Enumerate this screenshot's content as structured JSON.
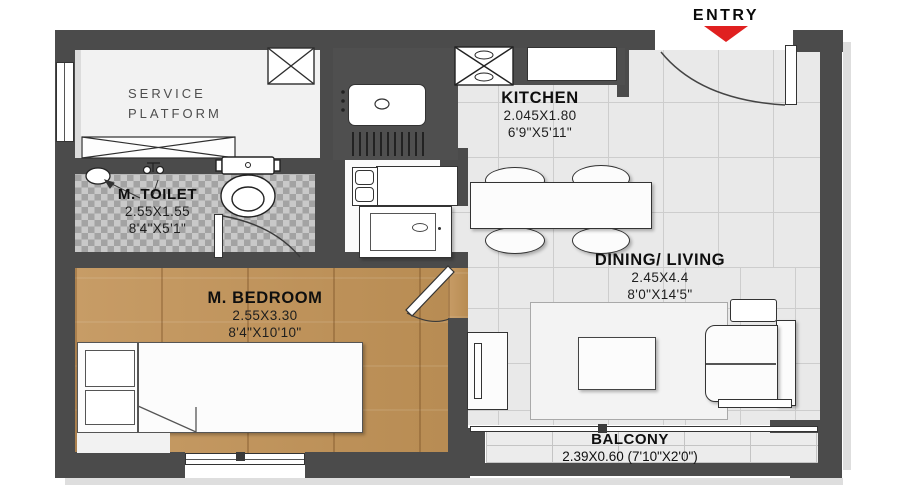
{
  "entry": {
    "label": "ENTRY"
  },
  "rooms": {
    "service_platform": {
      "line1": "SERVICE",
      "line2": "PLATFORM"
    },
    "kitchen": {
      "name": "KITCHEN",
      "dim_m": "2.045X1.80",
      "dim_ft": "6'9\"X5'11\""
    },
    "m_toilet": {
      "name": "M. TOILET",
      "dim_m": "2.55X1.55",
      "dim_ft": "8'4\"X5'1\""
    },
    "m_bedroom": {
      "name": "M. BEDROOM",
      "dim_m": "2.55X3.30",
      "dim_ft": "8'4\"X10'10\""
    },
    "dining_living": {
      "name": "DINING/ LIVING",
      "dim_m": "2.45X4.4",
      "dim_ft": "8'0\"X14'5\""
    },
    "balcony": {
      "name": "BALCONY",
      "dim": "2.39X0.60 (7'10\"X2'0\")"
    }
  },
  "colors": {
    "wall": "#4b4b4b",
    "entry_arrow": "#e02020",
    "wood_floor": "#c59a63",
    "tile_floor": "#e9e9e9",
    "toilet_tile": "#b5b5b5"
  },
  "fixtures": [
    "entry-door",
    "service-shaft",
    "service-ledge",
    "kitchen-sink",
    "drainboard",
    "stove-hob",
    "kitchen-counter",
    "wash-counter",
    "washbasin-unit",
    "washing-machine",
    "wc-toilet",
    "toilet-basin",
    "shower-mixer",
    "toilet-door",
    "bed",
    "nightstands",
    "bedroom-door",
    "bedroom-window",
    "dining-table",
    "dining-chairs",
    "rug",
    "coffee-table",
    "tv-unit",
    "sofa",
    "sofa-side-table",
    "balcony-slider",
    "left-window"
  ]
}
